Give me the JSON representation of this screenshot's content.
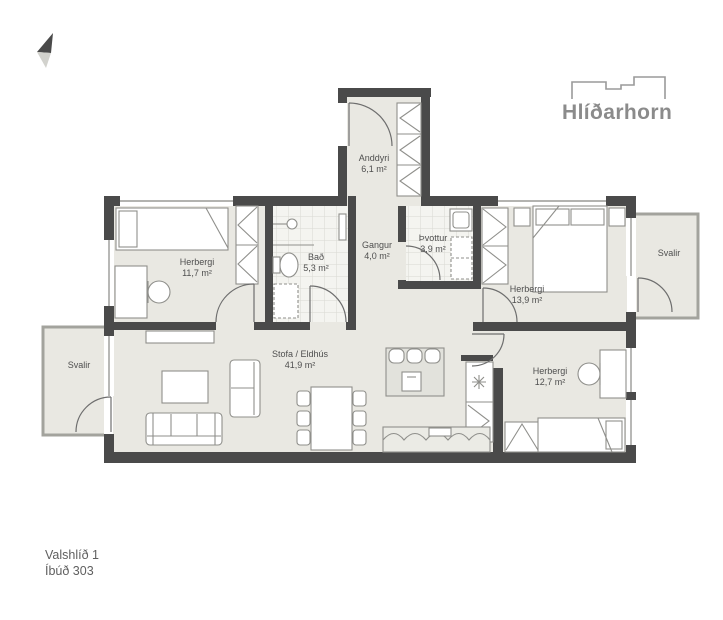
{
  "plan": {
    "project_name": "Hlíðarhorn",
    "address": "Valshlíð 1",
    "apartment": "Íbúð 303"
  },
  "rooms": [
    {
      "name": "Anddyri",
      "area": "6,1 m²"
    },
    {
      "name": "Gangur",
      "area": "4,0 m²"
    },
    {
      "name": "Bað",
      "area": "5,3 m²"
    },
    {
      "name": "Þvottur",
      "area": "3,9 m²"
    },
    {
      "name": "Herbergi",
      "area": "11,7 m²"
    },
    {
      "name": "Herbergi",
      "area": "13,9 m²"
    },
    {
      "name": "Herbergi",
      "area": "12,7 m²"
    },
    {
      "name": "Stofa / Eldhús",
      "area": "41,9 m²"
    },
    {
      "name": "Svalir"
    },
    {
      "name": "Svalir"
    }
  ],
  "icons": {
    "north_arrow": "north-arrow",
    "logo_building": "building-outline"
  },
  "colors": {
    "wall": "#4a4a4a",
    "floor": "#e9e8e2",
    "tile_floor": "#f4f4f0",
    "logo_gray": "#8b8b8b",
    "label_gray": "#4f4f4f"
  }
}
